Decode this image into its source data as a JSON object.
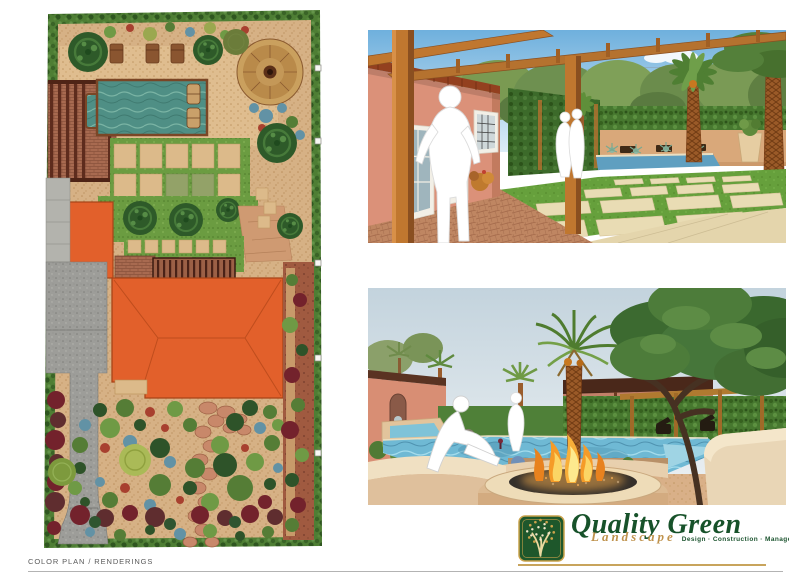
{
  "sheet": {
    "title_block_label": "COLOR PLAN / RENDERINGS"
  },
  "logo": {
    "company": "Quality Green",
    "division": "Landscape",
    "tagline": "Design · Construction · Management"
  },
  "colors": {
    "brand_green": "#17522a",
    "brand_gold": "#bf924c",
    "house_orange": "#e2602b",
    "plan_pool_teal": "#4f8f85",
    "rendering_pool_blue": "#6fb9d4",
    "lawn_green": "#66a03c",
    "sky_blue": "#79b2dc",
    "wall_tan": "#d9a87a",
    "hedge_green": "#4e7e34",
    "label_gray": "#5a5a5a"
  }
}
